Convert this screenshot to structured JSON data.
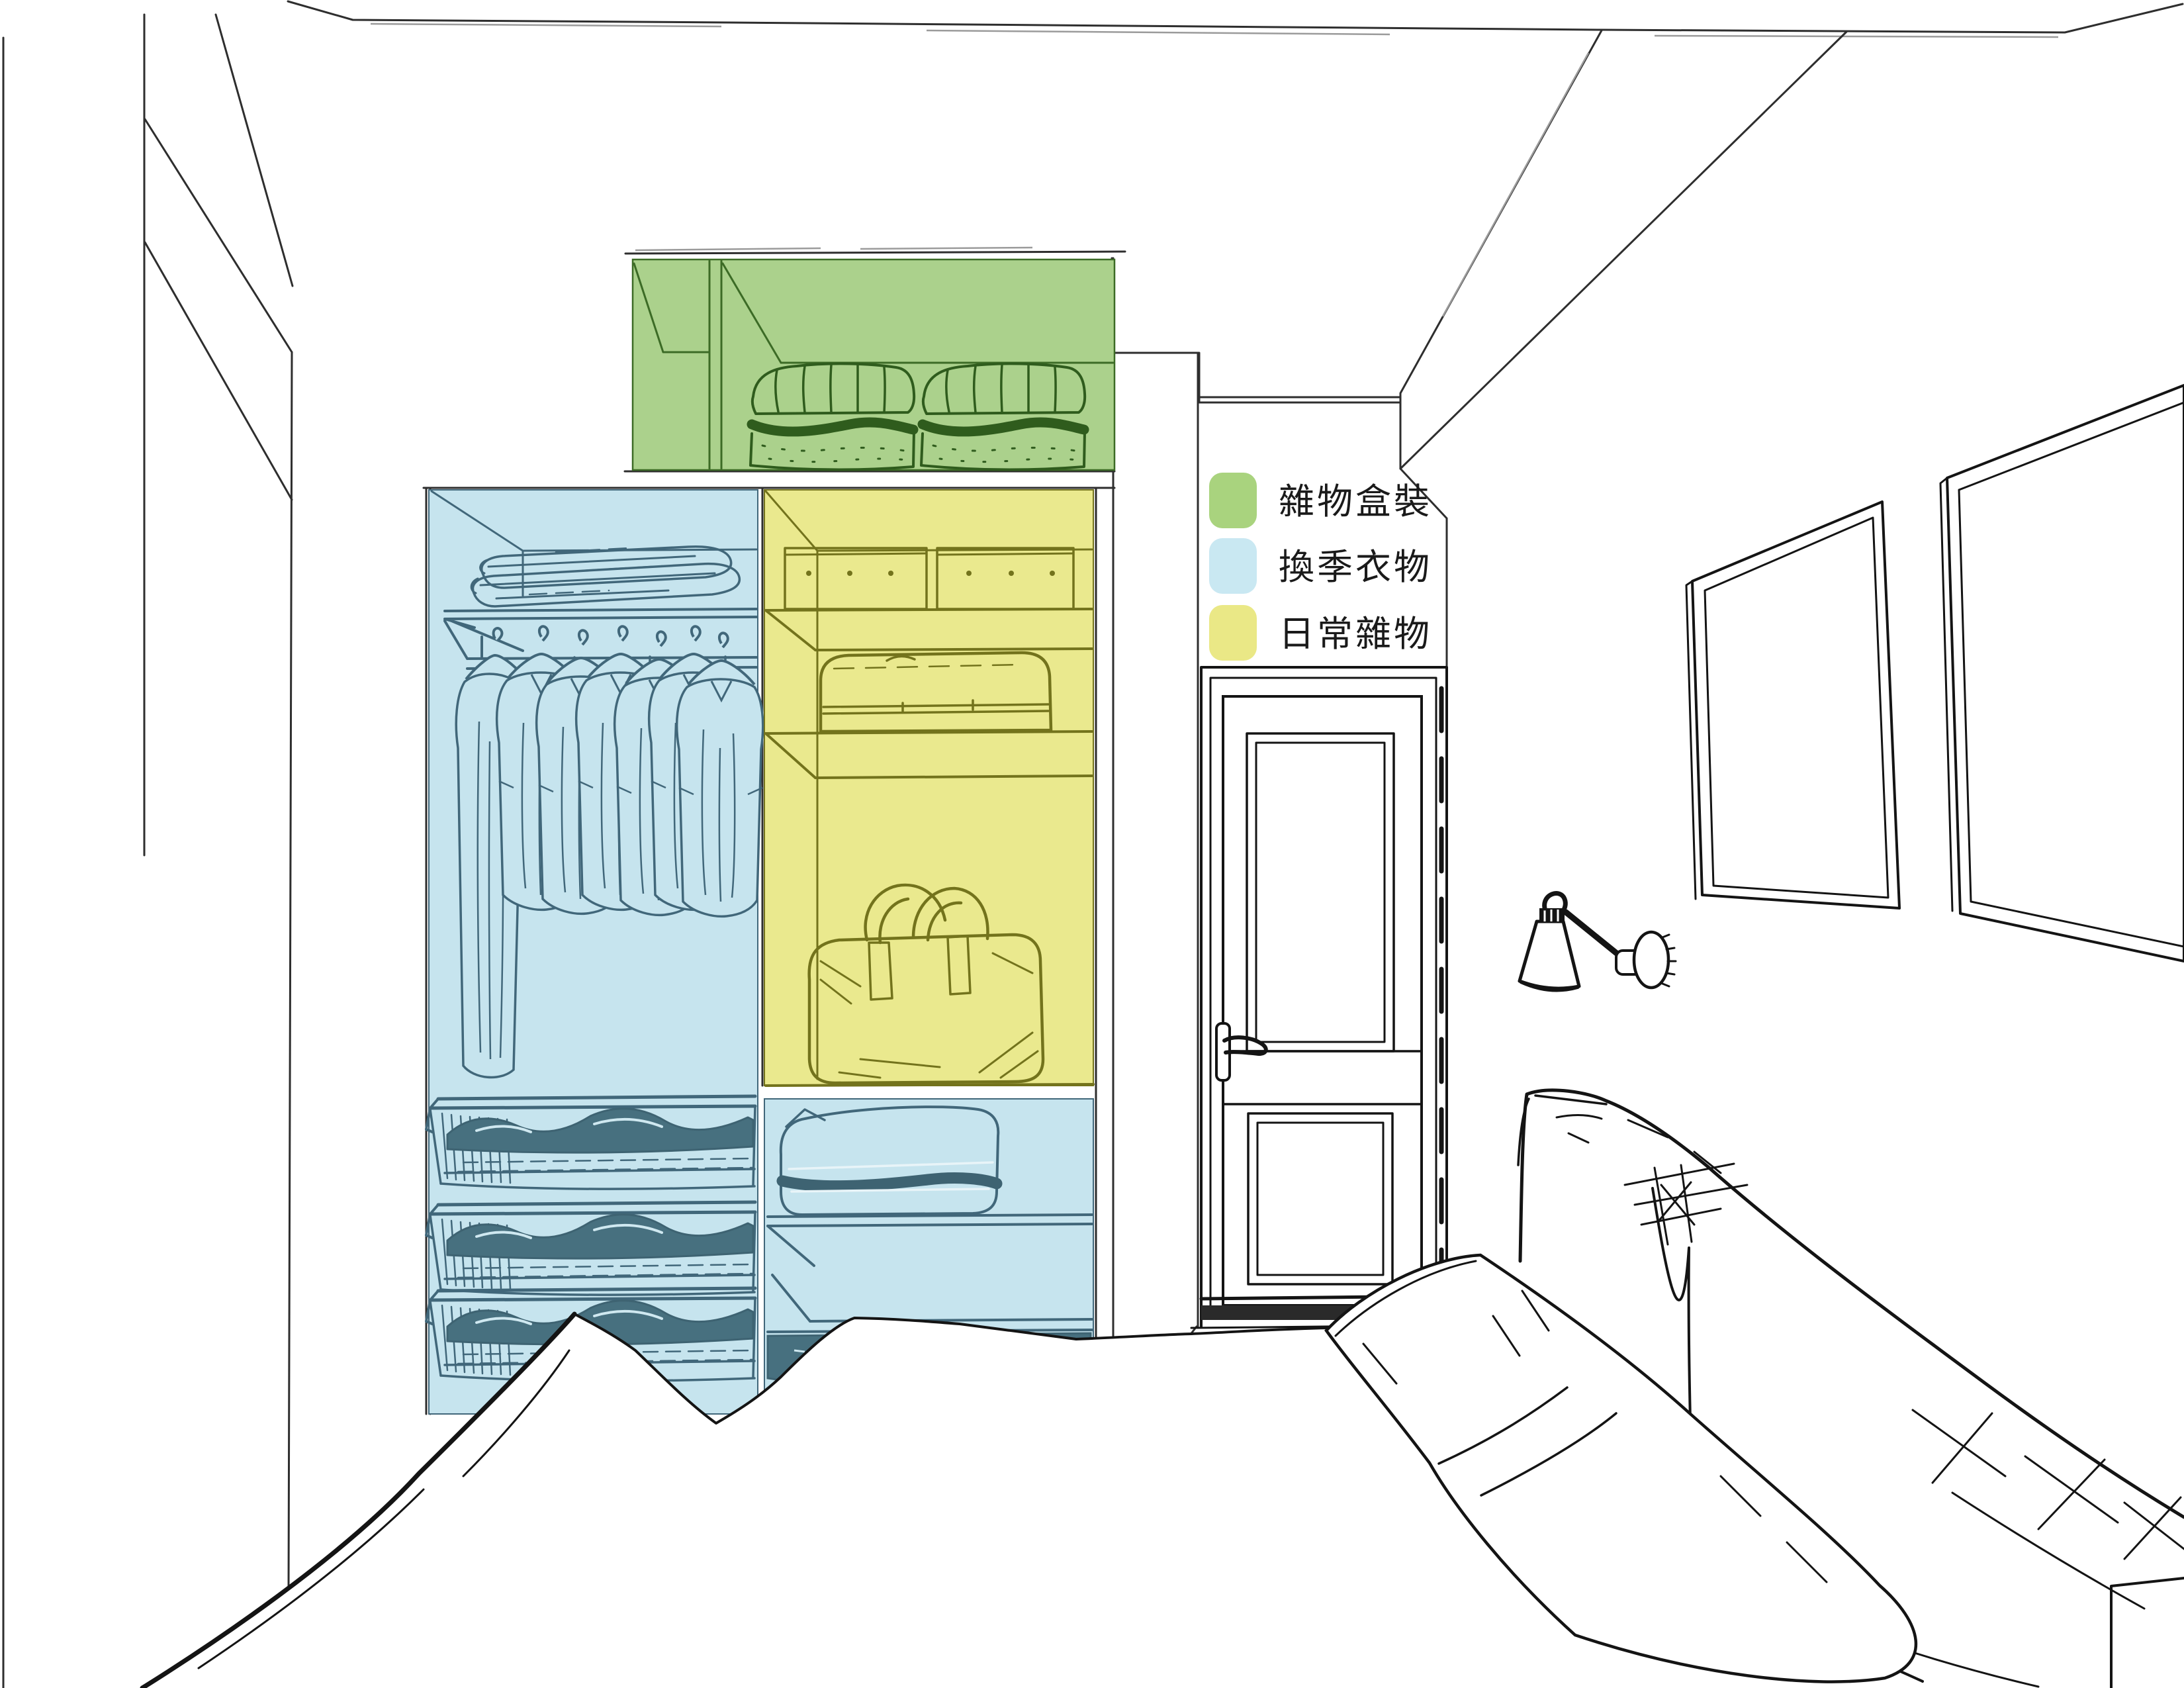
{
  "scene": {
    "description": "Hand-drawn perspective sketch of a small bedroom: a recessed closet with color-coded storage zones, a panel door, a wall lamp, two picture frames and a bed with pillows and headboard"
  },
  "colors": {
    "green_fill": "#abd18c",
    "green_line": "#3c6b26",
    "blue_fill": "#c6e4ee",
    "blue_line": "#41677a",
    "blue_dark": "#47707f",
    "yellow_fill": "#eae98e",
    "yellow_line": "#73731c",
    "sketch_line": "#141414",
    "wall_line": "#2e2e2e"
  },
  "legend": {
    "items": [
      {
        "id": "boxed-sundries",
        "label": "雜物盒裝",
        "color": "#a9d37e"
      },
      {
        "id": "seasonal-clothing",
        "label": "換季衣物",
        "color": "#c9e8f2"
      },
      {
        "id": "daily-sundries",
        "label": "日常雜物",
        "color": "#eae886"
      }
    ]
  }
}
